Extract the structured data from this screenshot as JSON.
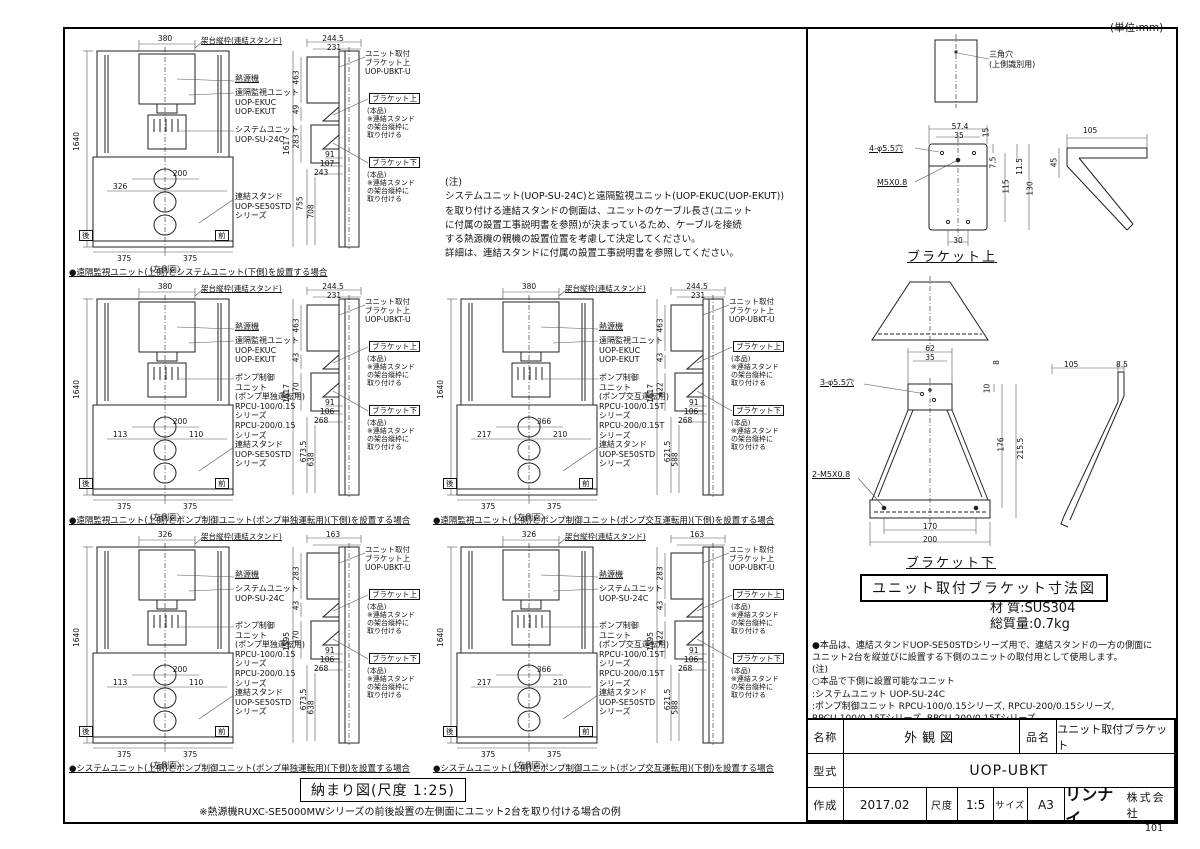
{
  "meta": {
    "unit_note": "(単位:mm)",
    "page_number": "101",
    "layout_title": "納まり図(尺度 1:25)",
    "layout_note": "※熱源機RUXC-SE5000MWシリーズの前後設置の左側面にユニット2台を取り付ける場合の例"
  },
  "notes": "(注)\nシステムユニット(UOP-SU-24C)と遠隔監視ユニット(UOP-EKUC(UOP-EKUT))\nを取り付ける連結スタンドの側面は、ユニットのケーブル長さ(ユニット\nに付属の設置工事説明書を参照)が決まっているため、ケーブルを接続\nする熱源機の親機の設置位置を考慮して決定してください。\n詳細は、連結スタンドに付属の設置工事説明書を参照してください。",
  "figures": [
    {
      "caption": "●遠隔監視ユニット(上側)とシステムユニット(下側)を設置する場合",
      "left": {
        "top_width": "380",
        "frame_label": "架台縦枠(連結スタンド)",
        "height": "1640",
        "heat_label": "熱源機",
        "upper_unit": "遠隔監視ユニット\nUOP-EKUC\nUOP-EKUT",
        "lower_unit": "システムユニット\nUOP-SU-24C",
        "stand": "連結スタンド\nUOP-SE50STD\nシリーズ",
        "mid_a": "200",
        "mid_b": "326",
        "mid_c": "",
        "base_l": "375",
        "base_r": "375",
        "rear": "後",
        "front": "前",
        "view_label": "〈左側面〉"
      },
      "right": {
        "top_w": "244.5",
        "top_w2": "231",
        "d1": "463",
        "d2": "49",
        "d3": "283",
        "total": "1617",
        "h1": "91",
        "h2": "107",
        "h3": "243",
        "b1": "755",
        "b2": "708",
        "unit_bracket": "ユニット取付\nブラケット上\nUOP-UBKT-U",
        "co_upper_title": "ブラケット上",
        "co_upper_body": "(本品)\n※連結スタンド\nの架台縦枠に\n取り付ける",
        "co_lower_title": "ブラケット下",
        "co_lower_body": "(本品)\n※連結スタンド\nの架台縦枠に\n取り付ける"
      }
    },
    {
      "caption": "●遠隔監視ユニット(上側)とポンプ制御ユニット(ポンプ単独運転用)(下側)を設置する場合",
      "left": {
        "top_width": "380",
        "frame_label": "架台縦枠(連結スタンド)",
        "height": "1640",
        "heat_label": "熱源機",
        "upper_unit": "遠隔監視ユニット\nUOP-EKUC\nUOP-EKUT",
        "lower_unit": "ポンプ制御\nユニット\n(ポンプ単独運転用)\nRPCU-100/0.15\nシリーズ\nRPCU-200/0.15\nシリーズ",
        "stand": "連結スタンド\nUOP-SE50STD\nシリーズ",
        "mid_a": "200",
        "mid_b": "113",
        "mid_c": "110",
        "base_l": "375",
        "base_r": "375",
        "rear": "後",
        "front": "前",
        "view_label": "〈左側面〉"
      },
      "right": {
        "top_w": "244.5",
        "top_w2": "231",
        "d1": "463",
        "d2": "43",
        "d3": "370",
        "total": "1617",
        "h1": "91",
        "h2": "106",
        "h3": "268",
        "b1": "673.5",
        "b2": "638",
        "unit_bracket": "ユニット取付\nブラケット上\nUOP-UBKT-U",
        "co_upper_title": "ブラケット上",
        "co_upper_body": "(本品)\n※連結スタンド\nの架台縦枠に\n取り付ける",
        "co_lower_title": "ブラケット下",
        "co_lower_body": "(本品)\n※連結スタンド\nの架台縦枠に\n取り付ける"
      }
    },
    {
      "caption": "●遠隔監視ユニット(上側)とポンプ制御ユニット(ポンプ交互運転用)(下側)を設置する場合",
      "left": {
        "top_width": "380",
        "frame_label": "架台縦枠(連結スタンド)",
        "height": "1640",
        "heat_label": "熱源機",
        "upper_unit": "遠隔監視ユニット\nUOP-EKUC\nUOP-EKUT",
        "lower_unit": "ポンプ制御\nユニット\n(ポンプ交互運転用)\nRPCU-100/0.15T\nシリーズ\nRPCU-200/0.15T\nシリーズ",
        "stand": "連結スタンド\nUOP-SE50STD\nシリーズ",
        "mid_a": "366",
        "mid_b": "217",
        "mid_c": "210",
        "base_l": "375",
        "base_r": "375",
        "rear": "後",
        "front": "前",
        "view_label": "〈左側面〉"
      },
      "right": {
        "top_w": "244.5",
        "top_w2": "231",
        "d1": "463",
        "d2": "43",
        "d3": "422",
        "total": "1617",
        "h1": "91",
        "h2": "106",
        "h3": "268",
        "b1": "621.5",
        "b2": "588",
        "unit_bracket": "ユニット取付\nブラケット上\nUOP-UBKT-U",
        "co_upper_title": "ブラケット上",
        "co_upper_body": "(本品)\n※連結スタンド\nの架台縦枠に\n取り付ける",
        "co_lower_title": "ブラケット下",
        "co_lower_body": "(本品)\n※連結スタンド\nの架台縦枠に\n取り付ける"
      }
    },
    {
      "caption": "●システムユニット(上側)とポンプ制御ユニット(ポンプ単独運転用)(下側)を設置する場合",
      "left": {
        "top_width": "326",
        "frame_label": "架台縦枠(連結スタンド)",
        "height": "1640",
        "heat_label": "熱源機",
        "upper_unit": "システムユニット\nUOP-SU-24C",
        "lower_unit": "ポンプ制御\nユニット\n(ポンプ単独運転用)\nRPCU-100/0.15\nシリーズ\nRPCU-200/0.15\nシリーズ",
        "stand": "連結スタンド\nUOP-SE50STD\nシリーズ",
        "mid_a": "200",
        "mid_b": "113",
        "mid_c": "110",
        "base_l": "375",
        "base_r": "375",
        "rear": "後",
        "front": "前",
        "view_label": "〈左側面〉"
      },
      "right": {
        "top_w": "163",
        "top_w2": "",
        "d1": "283",
        "d2": "43",
        "d3": "370",
        "total": "1595",
        "h1": "91",
        "h2": "106",
        "h3": "268",
        "b1": "673.5",
        "b2": "638",
        "unit_bracket": "ユニット取付\nブラケット上\nUOP-UBKT-U",
        "co_upper_title": "ブラケット上",
        "co_upper_body": "(本品)\n※連結スタンド\nの架台縦枠に\n取り付ける",
        "co_lower_title": "ブラケット下",
        "co_lower_body": "(本品)\n※連結スタンド\nの架台縦枠に\n取り付ける"
      }
    },
    {
      "caption": "●システムユニット(上側)とポンプ制御ユニット(ポンプ交互運転用)(下側)を設置する場合",
      "left": {
        "top_width": "326",
        "frame_label": "架台縦枠(連結スタンド)",
        "height": "1640",
        "heat_label": "熱源機",
        "upper_unit": "システムユニット\nUOP-SU-24C",
        "lower_unit": "ポンプ制御\nユニット\n(ポンプ交互運転用)\nRPCU-100/0.15T\nシリーズ\nRPCU-200/0.15T\nシリーズ",
        "stand": "連結スタンド\nUOP-SE50STD\nシリーズ",
        "mid_a": "366",
        "mid_b": "217",
        "mid_c": "210",
        "base_l": "375",
        "base_r": "375",
        "rear": "後",
        "front": "前",
        "view_label": "〈左側面〉"
      },
      "right": {
        "top_w": "163",
        "top_w2": "",
        "d1": "283",
        "d2": "43",
        "d3": "422",
        "total": "1595",
        "h1": "91",
        "h2": "106",
        "h3": "268",
        "b1": "621.5",
        "b2": "588",
        "unit_bracket": "ユニット取付\nブラケット上\nUOP-UBKT-U",
        "co_upper_title": "ブラケット上",
        "co_upper_body": "(本品)\n※連結スタンド\nの架台縦枠に\n取り付ける",
        "co_lower_title": "ブラケット下",
        "co_lower_body": "(本品)\n※連結スタンド\nの架台縦枠に\n取り付ける"
      }
    }
  ],
  "bracket_top": {
    "title": "ブラケット上",
    "triangle_hole": "三角穴\n(上側識別用)",
    "holes": "4-φ5.5穴",
    "thread": "M5X0.8",
    "w_outer": "57.4",
    "w_inner": "35",
    "t_top": "15",
    "v1": "7.5",
    "v2": "115",
    "v3": "11.5",
    "v4": "130",
    "w_bottom": "30",
    "side_w": "105",
    "side_h": "45"
  },
  "bracket_bottom": {
    "title": "ブラケット下",
    "holes": "3-φ5.5穴",
    "thread": "2-M5X0.8",
    "w_top": "62",
    "w_inner": "35",
    "t": "8",
    "v0": "10",
    "v1": "176",
    "v2": "215.5",
    "w_b1": "170",
    "w_b2": "200",
    "side_w": "105",
    "side_t": "8.5"
  },
  "dim_fig_title": "ユニット取付ブラケット寸法図",
  "spec": {
    "material": "材 質:SUS304",
    "weight": "総質量:0.7kg"
  },
  "usage": "●本品は、連結スタンドUOP-SE50STDシリーズ用で、連結スタンドの一方の側面に\n ユニット2台を縦並びに設置する下側のユニットの取付用として使用します。\n (注)\n  ○本品で下側に設置可能なユニット\n    :システムユニット  UOP-SU-24C\n    :ポンプ制御ユニット  RPCU-100/0.15シリーズ, RPCU-200/0.15シリーズ,\n               RPCU-100/0.15Tシリーズ, RPCU-200/0.15Tシリーズ\n  ○本品で下側に設置不可能なユニット\n    :遠隔監視ユニット  UOP-EKUC (UOP-EKUT)",
  "title_block": {
    "name_label": "名称",
    "name_value": "外観図",
    "product_label": "品名",
    "product_value": "ユニット取付ブラケット",
    "model_label": "型式",
    "model_value": "UOP-UBKT",
    "created_label": "作成",
    "created_value": "2017.02",
    "scale_label": "尺度",
    "scale_value": "1:5",
    "size_label": "サイズ",
    "size_value": "A3",
    "company_logo": "リンナイ",
    "company_suffix": "株式会社"
  }
}
